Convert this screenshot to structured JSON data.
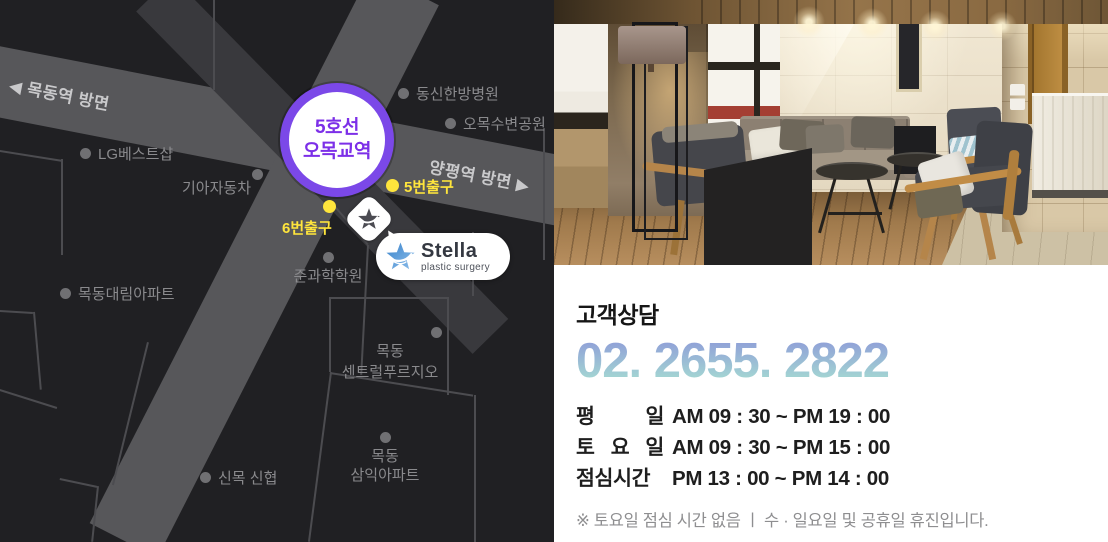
{
  "map": {
    "direction_left": "◀ 목동역 방면",
    "direction_right": "양평역 방면 ▶",
    "station": {
      "line": "5호선",
      "name": "오목교역"
    },
    "exits": [
      {
        "label": "5번출구"
      },
      {
        "label": "6번출구"
      }
    ],
    "landmarks": [
      {
        "label": "LG베스트샵"
      },
      {
        "label": "기아자동차"
      },
      {
        "label": "동신한방병원"
      },
      {
        "label": "오목수변공원"
      },
      {
        "label": "목동대림아파트"
      },
      {
        "label": "준과학학원"
      },
      {
        "label": "목동\n센트럴푸르지오"
      },
      {
        "label": "신목 신협"
      },
      {
        "label": "목동\n삼익아파트"
      }
    ],
    "clinic": {
      "brand": "Stella",
      "tagline": "plastic surgery"
    }
  },
  "info": {
    "heading": "고객상담",
    "phone": "02. 2655. 2822",
    "hours": [
      {
        "day": "평 일",
        "time": "AM 09 : 30 ~ PM 19 : 00"
      },
      {
        "day": "토 요 일",
        "time": "AM 09 : 30 ~ PM 15 : 00"
      },
      {
        "day": "점심시간",
        "time": "PM 13 : 00 ~ PM 14 : 00"
      }
    ],
    "note": "※ 토요일 점심 시간 없음  ㅣ  수 · 일요일 및 공휴일 휴진입니다."
  },
  "colors": {
    "accent_purple": "#7b48e8",
    "exit_yellow": "#ffe53c",
    "phone_gradient_top": "#8f9ed8",
    "phone_gradient_bottom": "#a6dcd2",
    "stella_blue": "#3c85cc"
  }
}
